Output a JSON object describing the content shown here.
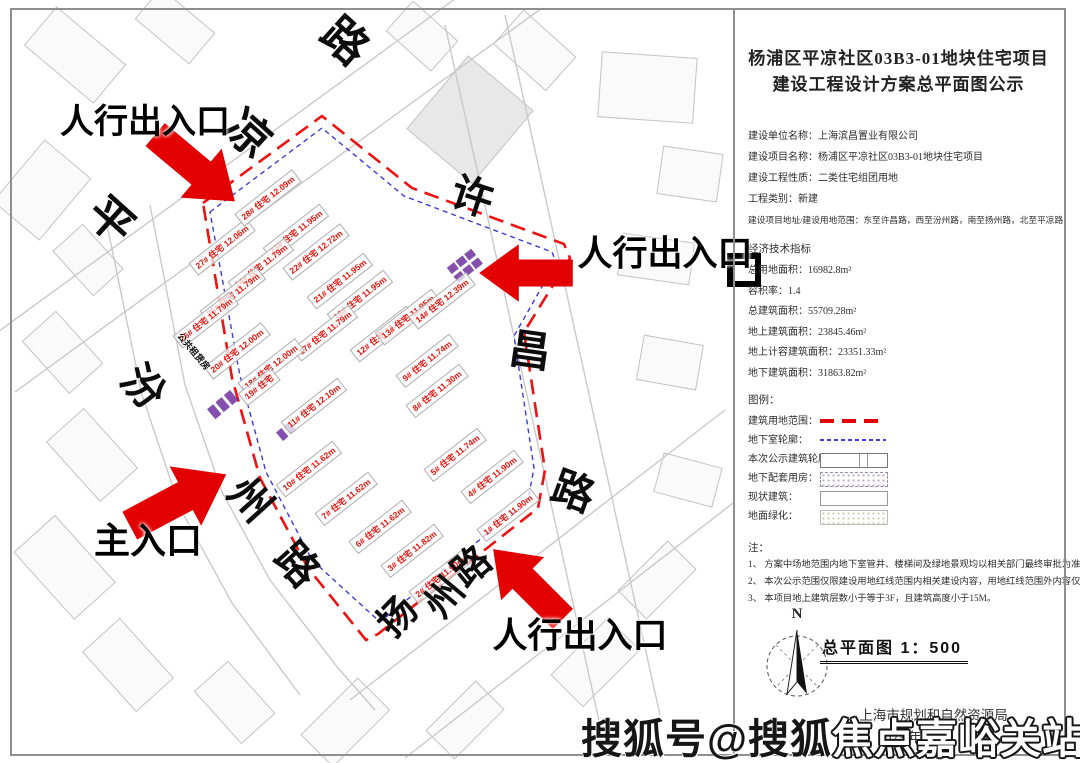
{
  "title": {
    "line1": "杨浦区平凉社区03B3-01地块住宅项目",
    "line2": "建设工程设计方案总平面图公示"
  },
  "info_lines": [
    "建设单位名称：上海滨昌置业有限公司",
    "建设项目名称：杨浦区平凉社区03B3-01地块住宅项目",
    "建设工程性质：二类住宅组团用地",
    "工程类别：新建",
    "建设项目地址/建设用地范围：东至许昌路，西至汾州路，南至扬州路，北至平凉路"
  ],
  "indicators": {
    "heading": "经济技术指标",
    "lines": [
      "总用地面积：16982.8m²",
      "容积率：1.4",
      "总建筑面积：55709.28m²",
      "地上建筑面积：23845.46m²",
      "地上计容建筑面积：23351.33m²",
      "地下建筑面积：31863.82m²"
    ]
  },
  "legend": {
    "heading": "图例：",
    "items": [
      {
        "label": "建筑用地范围：",
        "symbol": "sw-red-dash"
      },
      {
        "label": "地下室轮廓：",
        "symbol": "sw-blue-dash"
      },
      {
        "label": "本次公示建筑轮廓：",
        "symbol": "sw-outline"
      },
      {
        "label": "地下配套用房：",
        "symbol": "sw-purple-dots"
      },
      {
        "label": "现状建筑：",
        "symbol": "sw-plain"
      },
      {
        "label": "地面绿化：",
        "symbol": "sw-green-dots"
      }
    ]
  },
  "notes": {
    "heading": "注：",
    "items": [
      "1、 方案中场地范围内地下室管井、楼梯间及绿地景观均以相关部门最终审批为准。",
      "2、 本次公示范围仅限建设用地红线范围内相关建设内容，用地红线范围外内容仅为示意。",
      "3、 本项目地上建筑层数小于等于3F，且建筑高度小于15M。"
    ]
  },
  "compass_label": "N",
  "scale_text": "总平面图 1：500",
  "agency": "上海市规划和自然资源局",
  "date": "2023 年 06 月 21 日",
  "watermark": {
    "part1": "搜狐号@搜狐",
    "part2": "焦点嘉峪关站"
  },
  "map": {
    "colors": {
      "boundary_red": "#ee1111",
      "underground_blue": "#3b3bd6",
      "label_red": "#e8130c",
      "arrow_red": "#e30000",
      "purple": "#7030a0"
    },
    "entrances": [
      {
        "label": "人行出入口",
        "x": 145,
        "y": 122,
        "size": 34
      },
      {
        "label": "人行出入口",
        "x": 665,
        "y": 254,
        "size": 35
      },
      {
        "label": "主入口",
        "x": 148,
        "y": 541,
        "size": 36
      },
      {
        "label": "人行出入口",
        "x": 580,
        "y": 636,
        "size": 35
      }
    ],
    "road_labels": [
      {
        "ch": "路",
        "x": 345,
        "y": 41,
        "rot": 42,
        "size": 45
      },
      {
        "ch": "凉",
        "x": 248,
        "y": 134,
        "rot": 42,
        "size": 45
      },
      {
        "ch": "平",
        "x": 111,
        "y": 220,
        "rot": 42,
        "size": 45
      },
      {
        "ch": "许",
        "x": 472,
        "y": 197,
        "rot": 18,
        "size": 42
      },
      {
        "ch": "昌",
        "x": 530,
        "y": 351,
        "rot": 8,
        "size": 42
      },
      {
        "ch": "路",
        "x": 573,
        "y": 492,
        "rot": 20,
        "size": 42
      },
      {
        "ch": "汾",
        "x": 143,
        "y": 387,
        "rot": 48,
        "size": 42
      },
      {
        "ch": "州",
        "x": 250,
        "y": 500,
        "rot": 48,
        "size": 42
      },
      {
        "ch": "路",
        "x": 297,
        "y": 565,
        "rot": 48,
        "size": 42
      },
      {
        "ch": "扬",
        "x": 398,
        "y": 617,
        "rot": -46,
        "size": 38
      },
      {
        "ch": "州",
        "x": 445,
        "y": 598,
        "rot": -50,
        "size": 38
      },
      {
        "ch": "路",
        "x": 472,
        "y": 567,
        "rot": -40,
        "size": 38
      }
    ],
    "small_labels": [
      {
        "text": "公共租赁房",
        "x": 193,
        "y": 352,
        "rot": 50,
        "size": 9
      }
    ],
    "buildings": [
      {
        "label": "27# 住宅 12.06m",
        "x": 222,
        "y": 247,
        "rot": -38
      },
      {
        "label": "28# 住宅 12.09m",
        "x": 268,
        "y": 198,
        "rot": -38
      },
      {
        "label": "23# 住宅 11.95m",
        "x": 296,
        "y": 232,
        "rot": -38
      },
      {
        "label": "22# 住宅 12.72m",
        "x": 316,
        "y": 252,
        "rot": -38
      },
      {
        "label": "21# 住宅 11.95m",
        "x": 340,
        "y": 281,
        "rot": -38
      },
      {
        "label": "16# 住宅 11.95m",
        "x": 360,
        "y": 298,
        "rot": -38
      },
      {
        "label": "24# 住宅 11.79m",
        "x": 261,
        "y": 266,
        "rot": -38
      },
      {
        "label": "25# 住宅 11.79m",
        "x": 233,
        "y": 295,
        "rot": -38
      },
      {
        "label": "26# 住宅 11.79m",
        "x": 206,
        "y": 320,
        "rot": -38
      },
      {
        "label": "20# 住宅 12.00m",
        "x": 237,
        "y": 351,
        "rot": -38
      },
      {
        "label": "17# 住宅 11.79m",
        "x": 325,
        "y": 333,
        "rot": -38
      },
      {
        "label": "12# 住宅 11.95m",
        "x": 383,
        "y": 334,
        "rot": -38
      },
      {
        "label": "13# 住宅 11.95m",
        "x": 408,
        "y": 317,
        "rot": -38
      },
      {
        "label": "14# 住宅 12.39m",
        "x": 442,
        "y": 301,
        "rot": -38
      },
      {
        "label": "18# 住宅 12.00m",
        "x": 271,
        "y": 367,
        "rot": -38
      },
      {
        "label": "19# 住宅",
        "x": 259,
        "y": 387,
        "rot": -38
      },
      {
        "label": "11# 住宅 12.10m",
        "x": 314,
        "y": 406,
        "rot": -38
      },
      {
        "label": "9# 住宅 11.74m",
        "x": 427,
        "y": 361,
        "rot": -38
      },
      {
        "label": "8# 住宅 11.30m",
        "x": 437,
        "y": 391,
        "rot": -38
      },
      {
        "label": "10# 住宅 11.62m",
        "x": 309,
        "y": 469,
        "rot": -38
      },
      {
        "label": "7# 住宅 11.62m",
        "x": 346,
        "y": 499,
        "rot": -38
      },
      {
        "label": "6# 住宅 11.62m",
        "x": 380,
        "y": 527,
        "rot": -38
      },
      {
        "label": "5# 住宅 11.74m",
        "x": 455,
        "y": 455,
        "rot": -38
      },
      {
        "label": "4# 住宅 11.90m",
        "x": 492,
        "y": 477,
        "rot": -38
      },
      {
        "label": "3# 住宅 11.82m",
        "x": 412,
        "y": 551,
        "rot": -38
      },
      {
        "label": "2# 住宅 11.90m",
        "x": 440,
        "y": 577,
        "rot": -38
      },
      {
        "label": "1# 住宅 11.90m",
        "x": 508,
        "y": 515,
        "rot": -38
      }
    ]
  }
}
